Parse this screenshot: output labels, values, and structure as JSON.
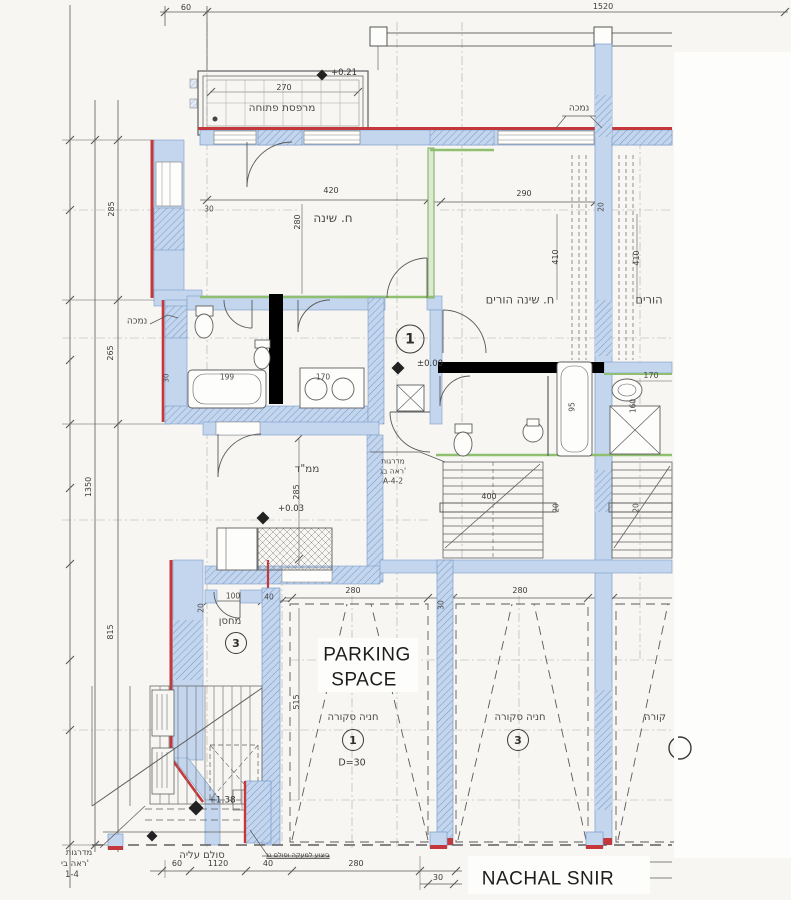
{
  "plan": {
    "street_label": "NACHAL SNIR",
    "parking_space": {
      "line1": "PARKING",
      "line2": "SPACE"
    },
    "rooms": {
      "balcony": "מרפסת פתוחה",
      "bedroom": "ח. שינה",
      "master_bedroom": "ח. שינה הורים",
      "master_bedroom_partial": "הורים",
      "mamad": "ממ\"ד",
      "storage": "מחסן",
      "covered_parking_1": "חניה סקורה",
      "covered_parking_2": "חניה סקורה",
      "covered_parking_3_partial": "קורה"
    },
    "unit_markers": {
      "entry": "1",
      "storage": "3",
      "parking_1": "1",
      "parking_2": "3"
    },
    "elevations": {
      "balcony": "+0.21",
      "entry": "±0.00",
      "mamad": "+0.03",
      "rear_yard": "+1.38"
    },
    "notes": {
      "lowered_right": "נמכה",
      "lowered_left": "נמכה",
      "entry_stairs_1": "מדרגות",
      "entry_stairs_2": "ראה בג'",
      "entry_stairs_3": "A-4-2",
      "left_stairs_1": "מדרגות",
      "left_stairs_2": "ראה בי'",
      "left_stairs_3": "1-4",
      "ladder": "סולם עליה",
      "railing_note": "ביצוע למעקה וסולם גג",
      "parking_diameter": "D=30"
    },
    "dimensions": {
      "top_60": "60",
      "top_1520": "1520",
      "left_285": "285",
      "left_265": "265",
      "left_1350": "1350",
      "left_815": "815",
      "bedroom_width": "420",
      "bedroom_depth": "280",
      "bedroom_wall": "30",
      "master_width": "290",
      "master_wall": "20",
      "closet_410_a": "410",
      "closet_410_b": "410",
      "balcony_270": "270",
      "tub_199": "199",
      "counter_170": "170",
      "bath_170": "170",
      "bath_160": "160",
      "tub_95": "95",
      "left_wall_30": "30",
      "stair_400": "400",
      "stair_wall_20_a": "20",
      "stair_wall_20_b": "20",
      "mamad_285": "285",
      "storage_100": "100",
      "storage_40": "40",
      "storage_20": "20",
      "parking_515": "515",
      "parking_280_a": "280",
      "parking_280_b": "280",
      "parking_30": "30",
      "bottom_60": "60",
      "bottom_1120": "1120",
      "bottom_40": "40",
      "bottom_280": "280",
      "bottom_30": "30"
    },
    "colors": {
      "wall_fill": "#c3d6ee",
      "wall_hatch": "#7b9cc9",
      "exterior_red": "#c4373b",
      "accent_green": "#8fbf6f",
      "ink": "#4a4a4a",
      "section_black": "#000000"
    }
  }
}
